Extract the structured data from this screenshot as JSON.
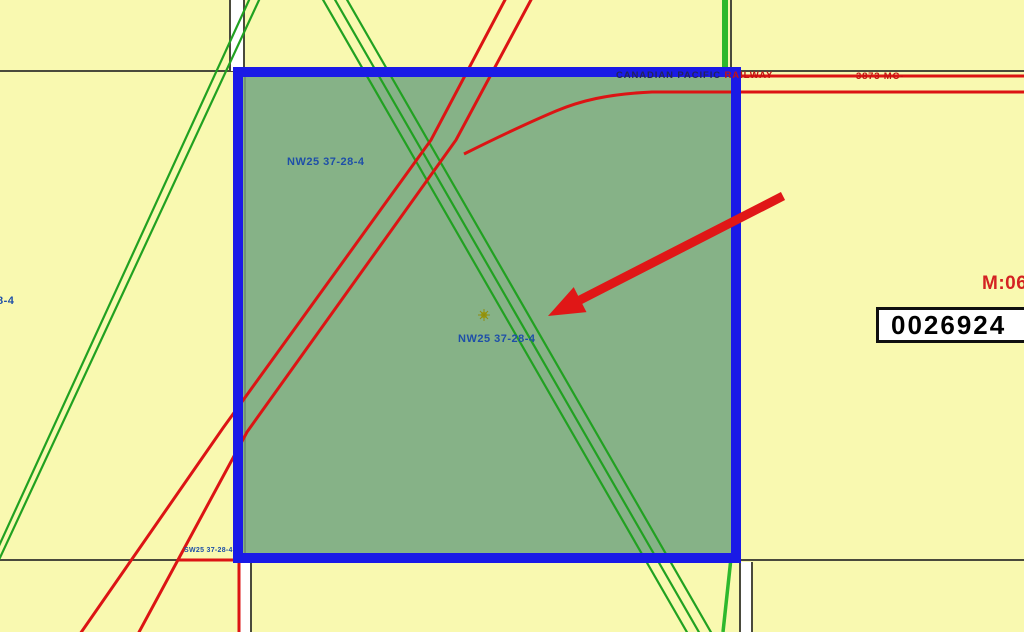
{
  "map": {
    "labels": {
      "parcel_top": "NW25 37-28-4",
      "parcel_center": "NW25 37-28-4",
      "railway_prefix": "CANADIAN PACIFIC",
      "railway_suffix": "RAILWAY",
      "mileage": "3873 MC-",
      "meridian": "M:06",
      "left_edge": "8-4",
      "corner": "SW25 37-28-4"
    },
    "id_box": {
      "value": "0026924"
    },
    "colors": {
      "background": "#f9f9b0",
      "parcel_fill": "#86b287",
      "parcel_border": "#1a1ae6",
      "railway_red": "#dc1414",
      "survey_green": "#21a121",
      "section_gray": "#4a4a3c",
      "road_allowance_white": "#ffffff",
      "arrow_red": "#e01717",
      "label_blue": "#1e4fa8",
      "id_text_black": "#000000"
    }
  }
}
